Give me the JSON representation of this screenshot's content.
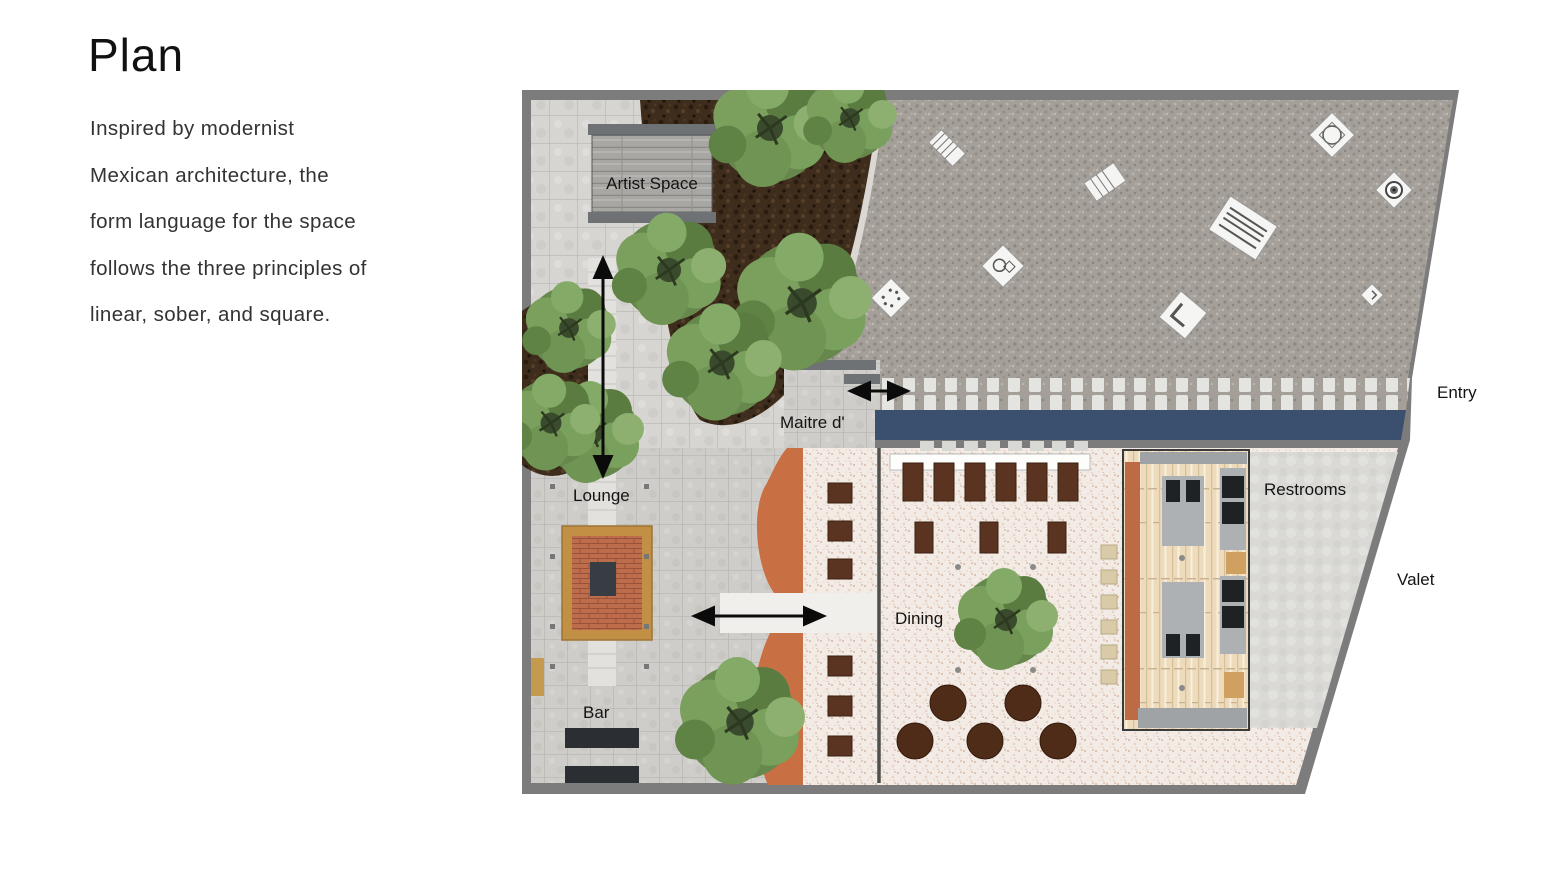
{
  "slide": {
    "title": "Plan",
    "body_lines": [
      "Inspired by modernist",
      "Mexican architecture, the",
      "form language for the space",
      "follows the three principles of",
      "linear, sober, and square."
    ]
  },
  "plan": {
    "area_labels": {
      "artist_space": "Artist Space",
      "maitre_d": "Maitre d'",
      "lounge": "Lounge",
      "bar": "Bar",
      "dining": "Dining",
      "restrooms": "Restrooms"
    },
    "outside_labels": {
      "entry": "Entry",
      "valet": "Valet"
    },
    "icons": {
      "tree": "tree-icon",
      "double_arrow": "double-arrow-icon",
      "plaza_object": "plaza-sculpture-icon",
      "firepit": "firepit-icon"
    },
    "colors": {
      "border_gray": "#7c7c7c",
      "gravel_plaza": "#a49f99",
      "tile_pavement": "#d5d3cf",
      "mulch_bed": "#3e2c1c",
      "entry_walkway_navy": "#3a506e",
      "terracotta_patio": "#c86f44",
      "dining_terrace_pink": "#f3ebe5",
      "tree_green": "#66884c",
      "firepit_brick": "#bd6d4c",
      "firepit_gold": "#c29045",
      "restroom_wood": "#eddbbc",
      "table_brown": "#4e2c18"
    }
  }
}
